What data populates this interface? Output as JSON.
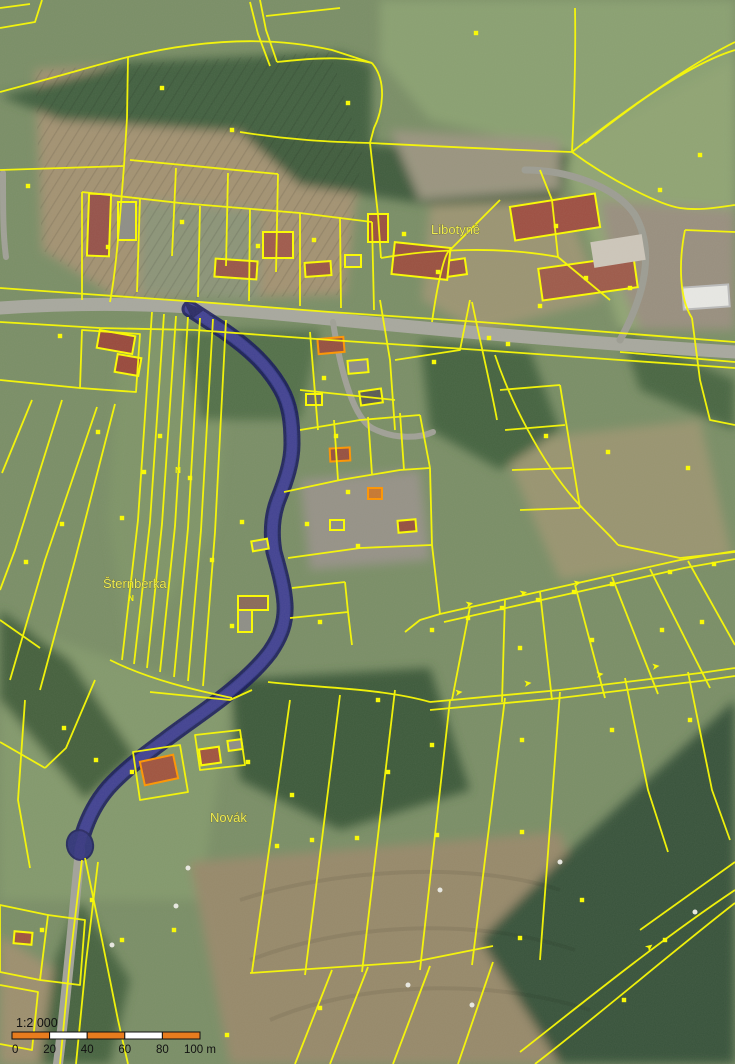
{
  "map": {
    "description": "cadastral-orthophoto-map",
    "colors": {
      "parcel_line": "#fcfc00",
      "building_outline_orange": "#ff9500",
      "route_fill": "#2b2b8a",
      "route_border": "#12125c",
      "road_gray": "#a6a69c",
      "base_green": "#768a63",
      "tree_green": "#3c5639",
      "field_brown": "#a29070",
      "scale_orange": "#e87c1e"
    },
    "place_labels": [
      {
        "id": "libotyne",
        "text": "Libotyně",
        "x": 431,
        "y": 234
      },
      {
        "id": "sternberka",
        "text": "Šternberka",
        "x": 103,
        "y": 588
      },
      {
        "id": "novak",
        "text": "Novák",
        "x": 210,
        "y": 822
      }
    ],
    "highlighted_route": {
      "name": "selected-road-parcel",
      "fill": "#2b2b8a",
      "border": "#12125c"
    },
    "buildings": [
      {
        "x": 88,
        "y": 194,
        "w": 22,
        "h": 62,
        "r": 2,
        "roof": "#96524a",
        "outline": "#fcfc00"
      },
      {
        "x": 118,
        "y": 202,
        "w": 18,
        "h": 38,
        "r": 0,
        "roof": "#8e8e86",
        "outline": "#fcfc00"
      },
      {
        "x": 215,
        "y": 260,
        "w": 42,
        "h": 18,
        "r": 4,
        "roof": "#9a5648",
        "outline": "#fcfc00"
      },
      {
        "x": 263,
        "y": 232,
        "w": 30,
        "h": 26,
        "r": 0,
        "roof": "#a05a4c",
        "outline": "#fcfc00"
      },
      {
        "x": 305,
        "y": 262,
        "w": 26,
        "h": 14,
        "r": -4,
        "roof": "#9a5648",
        "outline": "#fcfc00"
      },
      {
        "x": 345,
        "y": 255,
        "w": 16,
        "h": 12,
        "r": 0,
        "roof": "#8e8e86",
        "outline": "#fcfc00"
      },
      {
        "x": 395,
        "y": 256,
        "w": 32,
        "h": 16,
        "r": -6,
        "roof": "#a05a4c",
        "outline": "#fcfc00"
      },
      {
        "x": 440,
        "y": 260,
        "w": 26,
        "h": 16,
        "r": -8,
        "roof": "#9a5648",
        "outline": "#fcfc00"
      },
      {
        "x": 512,
        "y": 200,
        "w": 86,
        "h": 34,
        "r": -9,
        "roof": "#9e4f42",
        "outline": "#fcfc00"
      },
      {
        "x": 540,
        "y": 262,
        "w": 96,
        "h": 32,
        "r": -8,
        "roof": "#9e5a4a",
        "outline": "#fcfc00"
      },
      {
        "x": 592,
        "y": 238,
        "w": 52,
        "h": 26,
        "r": -9,
        "roof": "#cdc6ba",
        "outline": "none"
      },
      {
        "x": 393,
        "y": 245,
        "w": 56,
        "h": 32,
        "r": 6,
        "roof": "#9a5040",
        "outline": "#fcfc00"
      },
      {
        "x": 368,
        "y": 214,
        "w": 20,
        "h": 28,
        "r": 0,
        "roof": "#9a5040",
        "outline": "#fcfc00"
      },
      {
        "x": 683,
        "y": 286,
        "w": 46,
        "h": 22,
        "r": -4,
        "roof": "#e8e8e4",
        "outline": "#bbbbbb"
      },
      {
        "x": 98,
        "y": 333,
        "w": 36,
        "h": 18,
        "r": 10,
        "roof": "#99493c",
        "outline": "#fcfc00"
      },
      {
        "x": 116,
        "y": 356,
        "w": 24,
        "h": 18,
        "r": 10,
        "roof": "#99493c",
        "outline": "#fcfc00"
      },
      {
        "x": 318,
        "y": 338,
        "w": 26,
        "h": 15,
        "r": -5,
        "roof": "#965040",
        "outline": "#ff9500"
      },
      {
        "x": 348,
        "y": 360,
        "w": 20,
        "h": 13,
        "r": -5,
        "roof": "#8e8e86",
        "outline": "#fcfc00"
      },
      {
        "x": 306,
        "y": 394,
        "w": 16,
        "h": 11,
        "r": 0,
        "roof": "#6a6a62",
        "outline": "#fcfc00"
      },
      {
        "x": 360,
        "y": 390,
        "w": 22,
        "h": 14,
        "r": -8,
        "roof": "#5a5a54",
        "outline": "#fcfc00"
      },
      {
        "x": 330,
        "y": 448,
        "w": 20,
        "h": 13,
        "r": -3,
        "roof": "#965040",
        "outline": "#ff9500"
      },
      {
        "x": 368,
        "y": 488,
        "w": 14,
        "h": 11,
        "r": 0,
        "roof": "#c87830",
        "outline": "#ff9500"
      },
      {
        "x": 398,
        "y": 520,
        "w": 18,
        "h": 12,
        "r": -5,
        "roof": "#965040",
        "outline": "#fcfc00"
      },
      {
        "x": 330,
        "y": 520,
        "w": 14,
        "h": 10,
        "r": 0,
        "roof": "#8e8e86",
        "outline": "#fcfc00"
      },
      {
        "x": 238,
        "y": 596,
        "w": 30,
        "h": 14,
        "r": 0,
        "roof": "#8a6a58",
        "outline": "#fcfc00"
      },
      {
        "x": 238,
        "y": 610,
        "w": 14,
        "h": 22,
        "r": 0,
        "roof": "#8e8e86",
        "outline": "#fcfc00"
      },
      {
        "x": 252,
        "y": 540,
        "w": 16,
        "h": 10,
        "r": -10,
        "roof": "#8e8e86",
        "outline": "#fcfc00"
      },
      {
        "x": 142,
        "y": 758,
        "w": 34,
        "h": 24,
        "r": -12,
        "roof": "#a0543f",
        "outline": "#ff9500"
      },
      {
        "x": 200,
        "y": 748,
        "w": 20,
        "h": 16,
        "r": -8,
        "roof": "#a0543f",
        "outline": "#fcfc00"
      },
      {
        "x": 228,
        "y": 740,
        "w": 14,
        "h": 10,
        "r": -8,
        "roof": "#8e8e86",
        "outline": "#fcfc00"
      },
      {
        "x": 14,
        "y": 932,
        "w": 18,
        "h": 12,
        "r": 5,
        "roof": "#a0543f",
        "outline": "#fcfc00"
      }
    ],
    "markers": [
      [
        476,
        33
      ],
      [
        162,
        88
      ],
      [
        348,
        103
      ],
      [
        232,
        130
      ],
      [
        28,
        186
      ],
      [
        60,
        336
      ],
      [
        108,
        247
      ],
      [
        182,
        222
      ],
      [
        258,
        246
      ],
      [
        314,
        240
      ],
      [
        404,
        234
      ],
      [
        556,
        226
      ],
      [
        586,
        278
      ],
      [
        438,
        272
      ],
      [
        489,
        338
      ],
      [
        540,
        306
      ],
      [
        630,
        288
      ],
      [
        688,
        468
      ],
      [
        608,
        452
      ],
      [
        546,
        436
      ],
      [
        508,
        344
      ],
      [
        434,
        362
      ],
      [
        324,
        378
      ],
      [
        336,
        436
      ],
      [
        348,
        492
      ],
      [
        358,
        546
      ],
      [
        307,
        524
      ],
      [
        242,
        522
      ],
      [
        212,
        560
      ],
      [
        178,
        470,
        "N"
      ],
      [
        190,
        478
      ],
      [
        160,
        436
      ],
      [
        144,
        472
      ],
      [
        122,
        518
      ],
      [
        62,
        524
      ],
      [
        98,
        432
      ],
      [
        26,
        562
      ],
      [
        131,
        598,
        "N"
      ],
      [
        232,
        626
      ],
      [
        320,
        622
      ],
      [
        432,
        630
      ],
      [
        468,
        618
      ],
      [
        502,
        608
      ],
      [
        538,
        600
      ],
      [
        574,
        592
      ],
      [
        612,
        584
      ],
      [
        670,
        572
      ],
      [
        714,
        564
      ],
      [
        520,
        648
      ],
      [
        592,
        640
      ],
      [
        662,
        630
      ],
      [
        702,
        622
      ],
      [
        378,
        700
      ],
      [
        432,
        745
      ],
      [
        522,
        740
      ],
      [
        612,
        730
      ],
      [
        690,
        720
      ],
      [
        312,
        840
      ],
      [
        277,
        846
      ],
      [
        357,
        838
      ],
      [
        437,
        835
      ],
      [
        522,
        832
      ],
      [
        582,
        900
      ],
      [
        624,
        1000
      ],
      [
        665,
        940
      ],
      [
        174,
        930
      ],
      [
        520,
        938
      ],
      [
        64,
        728
      ],
      [
        96,
        760
      ],
      [
        132,
        772
      ],
      [
        248,
        762
      ],
      [
        388,
        772
      ],
      [
        292,
        795
      ],
      [
        92,
        900
      ],
      [
        42,
        930
      ],
      [
        122,
        940
      ],
      [
        227,
        1035
      ],
      [
        320,
        1008
      ],
      [
        660,
        190
      ],
      [
        700,
        155
      ]
    ],
    "arrows": [
      {
        "x": 466,
        "y": 608,
        "r": -13
      },
      {
        "x": 520,
        "y": 597,
        "r": -13
      },
      {
        "x": 574,
        "y": 587,
        "r": -13
      },
      {
        "x": 455,
        "y": 696,
        "r": -7
      },
      {
        "x": 524,
        "y": 687,
        "r": -7
      },
      {
        "x": 596,
        "y": 678,
        "r": -7
      },
      {
        "x": 652,
        "y": 670,
        "r": -7
      },
      {
        "x": 648,
        "y": 952,
        "r": -38
      }
    ]
  },
  "scale_bar": {
    "ratio_text": "1:2 000",
    "tick_labels": [
      "0",
      "20",
      "40",
      "60",
      "80",
      "100 m"
    ],
    "segment_colors": [
      "#e87c1e",
      "#ffffff",
      "#e87c1e",
      "#ffffff",
      "#e87c1e"
    ],
    "bar": {
      "x": 12,
      "y": 1032,
      "width": 188,
      "height": 7
    }
  }
}
